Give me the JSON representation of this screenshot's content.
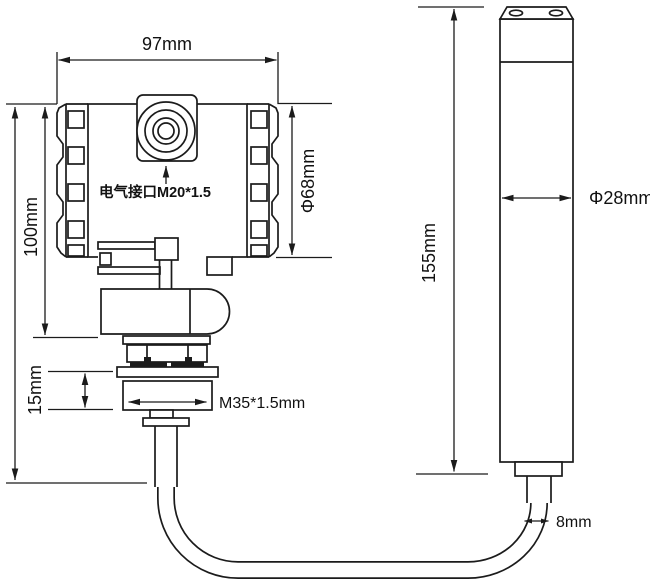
{
  "drawing": {
    "background": "#ffffff",
    "line_color": "#1b1b1b",
    "transmitter": {
      "width_label": "97mm",
      "height_label": "100mm",
      "thread_height_label": "15mm",
      "housing_diameter_label": "Φ68mm",
      "electrical_port_label": "电气接口M20*1.5",
      "process_thread_label": "M35*1.5mm"
    },
    "probe": {
      "length_label": "155mm",
      "diameter_label": "Φ28mm",
      "cable_diameter_label": "8mm"
    }
  }
}
